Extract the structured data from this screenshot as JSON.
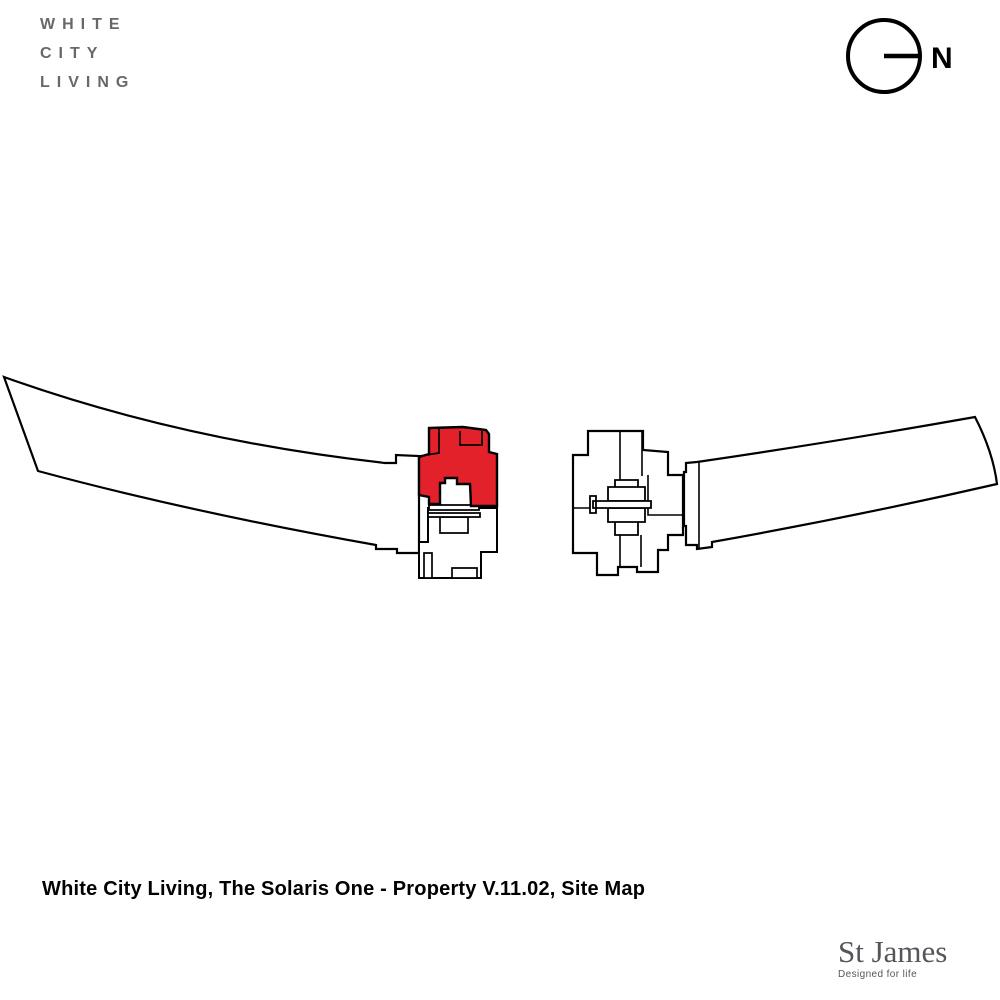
{
  "header": {
    "brand": {
      "lines": [
        "WHITE",
        "CITY",
        "LIVING"
      ]
    },
    "compass": {
      "label": "N"
    }
  },
  "caption": {
    "text": "White City Living, The Solaris One - Property V.11.02, Site Map"
  },
  "footer": {
    "developer_name": "St James",
    "developer_tagline": "Designed for life"
  },
  "colors": {
    "highlight_red": "#e3212b",
    "outline_black": "#000000",
    "brand_gray": "#68686c",
    "developer_gray": "#54565a",
    "background": "#ffffff"
  },
  "map": {
    "viewbox": "0 0 1000 1000",
    "layers": [
      {
        "id": "west-curved-block",
        "path": "M4,377 Q180,440 385,463 L396,463 L396,455 L419,456 L419,553 L397,553 L397,549 L376,549 L376,545 Q190,512 38,471 Z",
        "fill": "#ffffff",
        "stroke_width": 2.2
      },
      {
        "id": "east-curved-block",
        "path": "M686,463 L697,462 Q840,441 975,417 Q993,452 997,484 Q858,516 712,542 L712,547 L697,549 L697,545 L686,545 L686,526 L684,526 L684,472 L686,472 Z",
        "fill": "#ffffff",
        "stroke_width": 2.2
      },
      {
        "id": "east-block-inner-line",
        "path": "M699,462 L699,548",
        "fill": "none",
        "stroke_width": 1.6
      },
      {
        "id": "central-east-block",
        "path": "M588,431 L643,431 L643,450 L668,452 L668,475 L683,475 L683,535 L668,535 L668,550 L658,550 L658,572 L637,572 L637,567 L618,567 L618,575 L597,575 L597,553 L573,553 L573,455 L588,455 Z",
        "fill": "#ffffff",
        "stroke_width": 2.2
      },
      {
        "id": "central-east-block-inner-lines",
        "path": "M588,433 L588,455 M620,431 L620,481 M642,432 L642,476 M573,508 L592,508 M648,475 L648,515 L683,515 M620,535 L620,567 M641,535 L641,567",
        "fill": "none",
        "stroke_width": 1.6
      },
      {
        "id": "central-east-core-steps",
        "path": "M615,480 h23 v7 h-23 Z M608,487 h37 v14 h-37 Z M608,508 h37 v14 h-37 Z M615,522 h23 v13 h-23 Z",
        "fill": "#ffffff",
        "stroke_width": 1.8
      },
      {
        "id": "central-east-core-bar",
        "path": "M593,501 h58 v7 h-58 Z M590,496 h6 v17 h-6 Z",
        "fill": "#ffffff",
        "stroke_width": 1.8
      },
      {
        "id": "solaris-one-lower-body",
        "path": "M428,508 L497,508 L497,552 L481,552 L481,578 L419,578 L419,542 L428,542 Z",
        "fill": "#ffffff",
        "stroke_width": 2
      },
      {
        "id": "solaris-one-lower-rooms",
        "path": "M424,553 h8 v25 h-8 Z M452,568 h25 v10 h-25 Z M440,517 h28 v16 h-28 Z",
        "fill": "#ffffff",
        "stroke_width": 1.7
      },
      {
        "id": "solaris-one-link-bars",
        "path": "M429,505 h50 v5 h-50 Z M428,513 h52 v4 h-52 Z",
        "fill": "#ffffff",
        "stroke_width": 1.8
      },
      {
        "id": "solaris-one-highlight",
        "path": "M429,428 L463,427 L486,430 L489,434 L489,452 L497,454 L497,506 L471,506 L470,484 L457,484 L457,478 L445,478 L445,483 L440,483 L440,504 L429,504 L429,497 L419,495 L419,457 L429,454 Z",
        "fill": "#e3212b",
        "stroke_width": 2.4
      },
      {
        "id": "solaris-one-highlight-inner-lines",
        "path": "M439,429 L439,453 L420,456 M460,431 L460,445 L482,445 L482,431",
        "fill": "none",
        "stroke_width": 1.7
      }
    ]
  }
}
